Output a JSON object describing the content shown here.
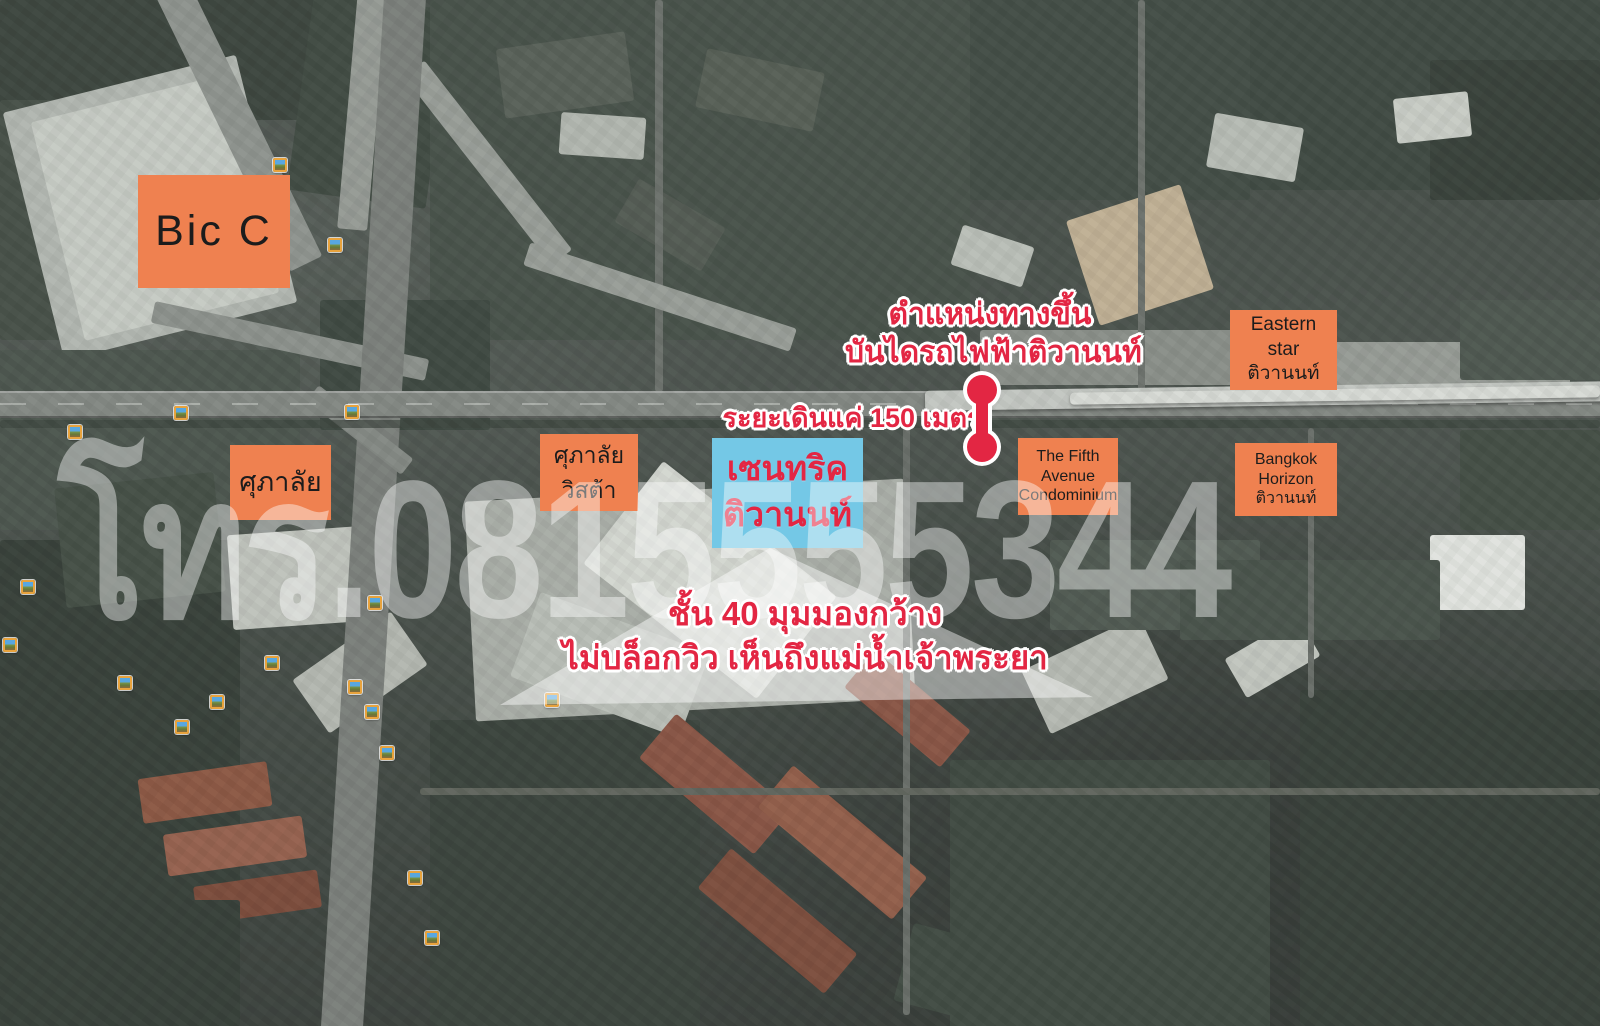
{
  "colors": {
    "box_orange": "#ef8150",
    "box_blue": "#74c8e6",
    "accent_red": "#e32643",
    "watermark_white": "rgba(255,255,255,0.42)"
  },
  "watermark": {
    "text": "โทร.0815555344"
  },
  "boxes": {
    "big_c": {
      "label": "Bic C"
    },
    "supalai": {
      "label": "ศุภาลัย"
    },
    "supalai_vista": {
      "line1": "ศุภาลัย",
      "line2": "วิสต้า"
    },
    "centric": {
      "line1": "เซนทริค",
      "line2": "ติวานนท์"
    },
    "eastern_star": {
      "line1": "Eastern",
      "line2": "star",
      "line3": "ติวานนท์"
    },
    "fifth_avenue": {
      "line1": "The Fifth",
      "line2": "Avenue",
      "line3": "Condominium"
    },
    "bangkok_horizon": {
      "line1": "Bangkok",
      "line2": "Horizon",
      "line3": "ติวานนท์"
    }
  },
  "annotations": {
    "station_entrance": {
      "line1": "ตำแหน่งทางขึ้น",
      "line2": "บันไดรถไฟฟ้าติวานนท์"
    },
    "walking_distance": {
      "text": "ระยะเดินแค่ 150 เมตร"
    },
    "view_note": {
      "line1": "ชั้น 40 มุมมองกว้าง",
      "line2": "ไม่บล็อกวิว เห็นถึงแม่น้ำเจ้าพระยา"
    }
  },
  "photo_icons": [
    [
      280,
      165
    ],
    [
      335,
      245
    ],
    [
      75,
      432
    ],
    [
      181,
      413
    ],
    [
      352,
      412
    ],
    [
      28,
      587
    ],
    [
      375,
      603
    ],
    [
      10,
      645
    ],
    [
      272,
      663
    ],
    [
      125,
      683
    ],
    [
      355,
      687
    ],
    [
      217,
      702
    ],
    [
      182,
      727
    ],
    [
      372,
      712
    ],
    [
      387,
      753
    ],
    [
      552,
      700
    ],
    [
      415,
      878
    ],
    [
      432,
      938
    ]
  ]
}
